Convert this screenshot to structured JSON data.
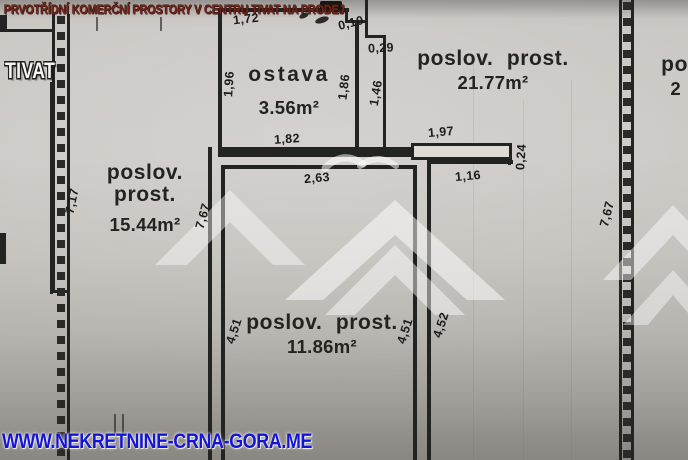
{
  "title": "PRVOTŘÍDNÍ KOMERČNÍ PROSTORY V CENTRU TIVAT NA PRODEJ",
  "location": "TIVAT",
  "footer_url": "WWW.NEKRETNINE-CRNA-GORA.ME",
  "rooms": [
    {
      "name": "ostava",
      "area": "3.56m²"
    },
    {
      "name": "poslov. prost.",
      "area": "21.77m²"
    },
    {
      "name": "poslov. prost.",
      "area": "15.44m²"
    },
    {
      "name": "poslov. prost.",
      "area": "11.86m²"
    },
    {
      "name": "po",
      "area": "2"
    }
  ],
  "dimensions": [
    "1,72",
    "0,10",
    "0,29",
    "1,96",
    "1,86",
    "1,46",
    "1,82",
    "2,63",
    "1,97",
    "0,24",
    "1,16",
    "7,17",
    "7,67",
    "4,51",
    "4,51",
    "4,52",
    "7,67"
  ],
  "colors": {
    "title_text": "#6e241b",
    "footer_url": "#1414d6",
    "plan_line": "#232321",
    "watermark": "#ffffff"
  }
}
